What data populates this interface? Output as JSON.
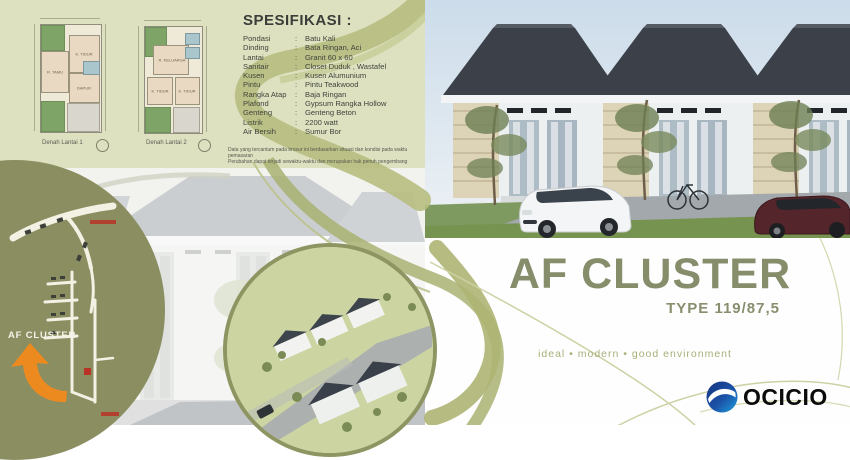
{
  "specs": {
    "title": "SPESIFIKASI :",
    "rows": [
      {
        "label": "Pondasi",
        "colon": ":",
        "value": "Batu Kali"
      },
      {
        "label": "Dinding",
        "colon": ":",
        "value": "Bata Ringan, Aci"
      },
      {
        "label": "Lantai",
        "colon": ":",
        "value": "Granit 60 x 60"
      },
      {
        "label": "Sanitair",
        "colon": ":",
        "value": "Closet Duduk , Wastafel"
      },
      {
        "label": "Kusen",
        "colon": ":",
        "value": "Kusen Alumunium"
      },
      {
        "label": "Pintu",
        "colon": ":",
        "value": "Pintu Teakwood"
      },
      {
        "label": "Rangka Atap",
        "colon": ":",
        "value": "Baja Ringan"
      },
      {
        "label": "Plafond",
        "colon": ":",
        "value": "Gypsum Rangka Hollow"
      },
      {
        "label": "Genteng",
        "colon": ":",
        "value": "Genteng Beton"
      },
      {
        "label": "Listrik",
        "colon": ":",
        "value": "2200 watt"
      },
      {
        "label": "Air Bersih",
        "colon": ":",
        "value": "Sumur Bor"
      }
    ],
    "disclaimer_line1": "Data yang tercantum pada brosur ini berdasarkan situasi dan kondisi pada waktu pemasaran",
    "disclaimer_line2": "Perubahan dapat terjadi sewaktu-waktu dan merupakan hak penuh pengembang"
  },
  "floorplans": {
    "plan1": {
      "caption": "Denah Lantai 1",
      "rooms": {
        "tamu": "R. TAMU",
        "tidur": "K. TIDUR",
        "dapur": "DAPUR"
      }
    },
    "plan2": {
      "caption": "Denah Lantai 2",
      "rooms": {
        "keluarga": "R. KELUARGA",
        "tidur1": "K. TIDUR",
        "tidur2": "K. TIDUR"
      }
    }
  },
  "map": {
    "label": "AF CLUSTER"
  },
  "hero": {
    "title": "AF CLUSTER",
    "type": "TYPE 119/87,5",
    "tagline": "ideal   •   modern   •   good environment"
  },
  "brand": {
    "name": "OCICIO"
  },
  "colors": {
    "sage_bg": "#dde1c0",
    "swirl_olive": "#b7be80",
    "map_olive": "#8a8e61",
    "arrow_orange": "#ec8a1f",
    "title_olive": "#858d6b",
    "brand_blue_dark": "#143d8f",
    "brand_blue_light": "#1fa0dc"
  }
}
